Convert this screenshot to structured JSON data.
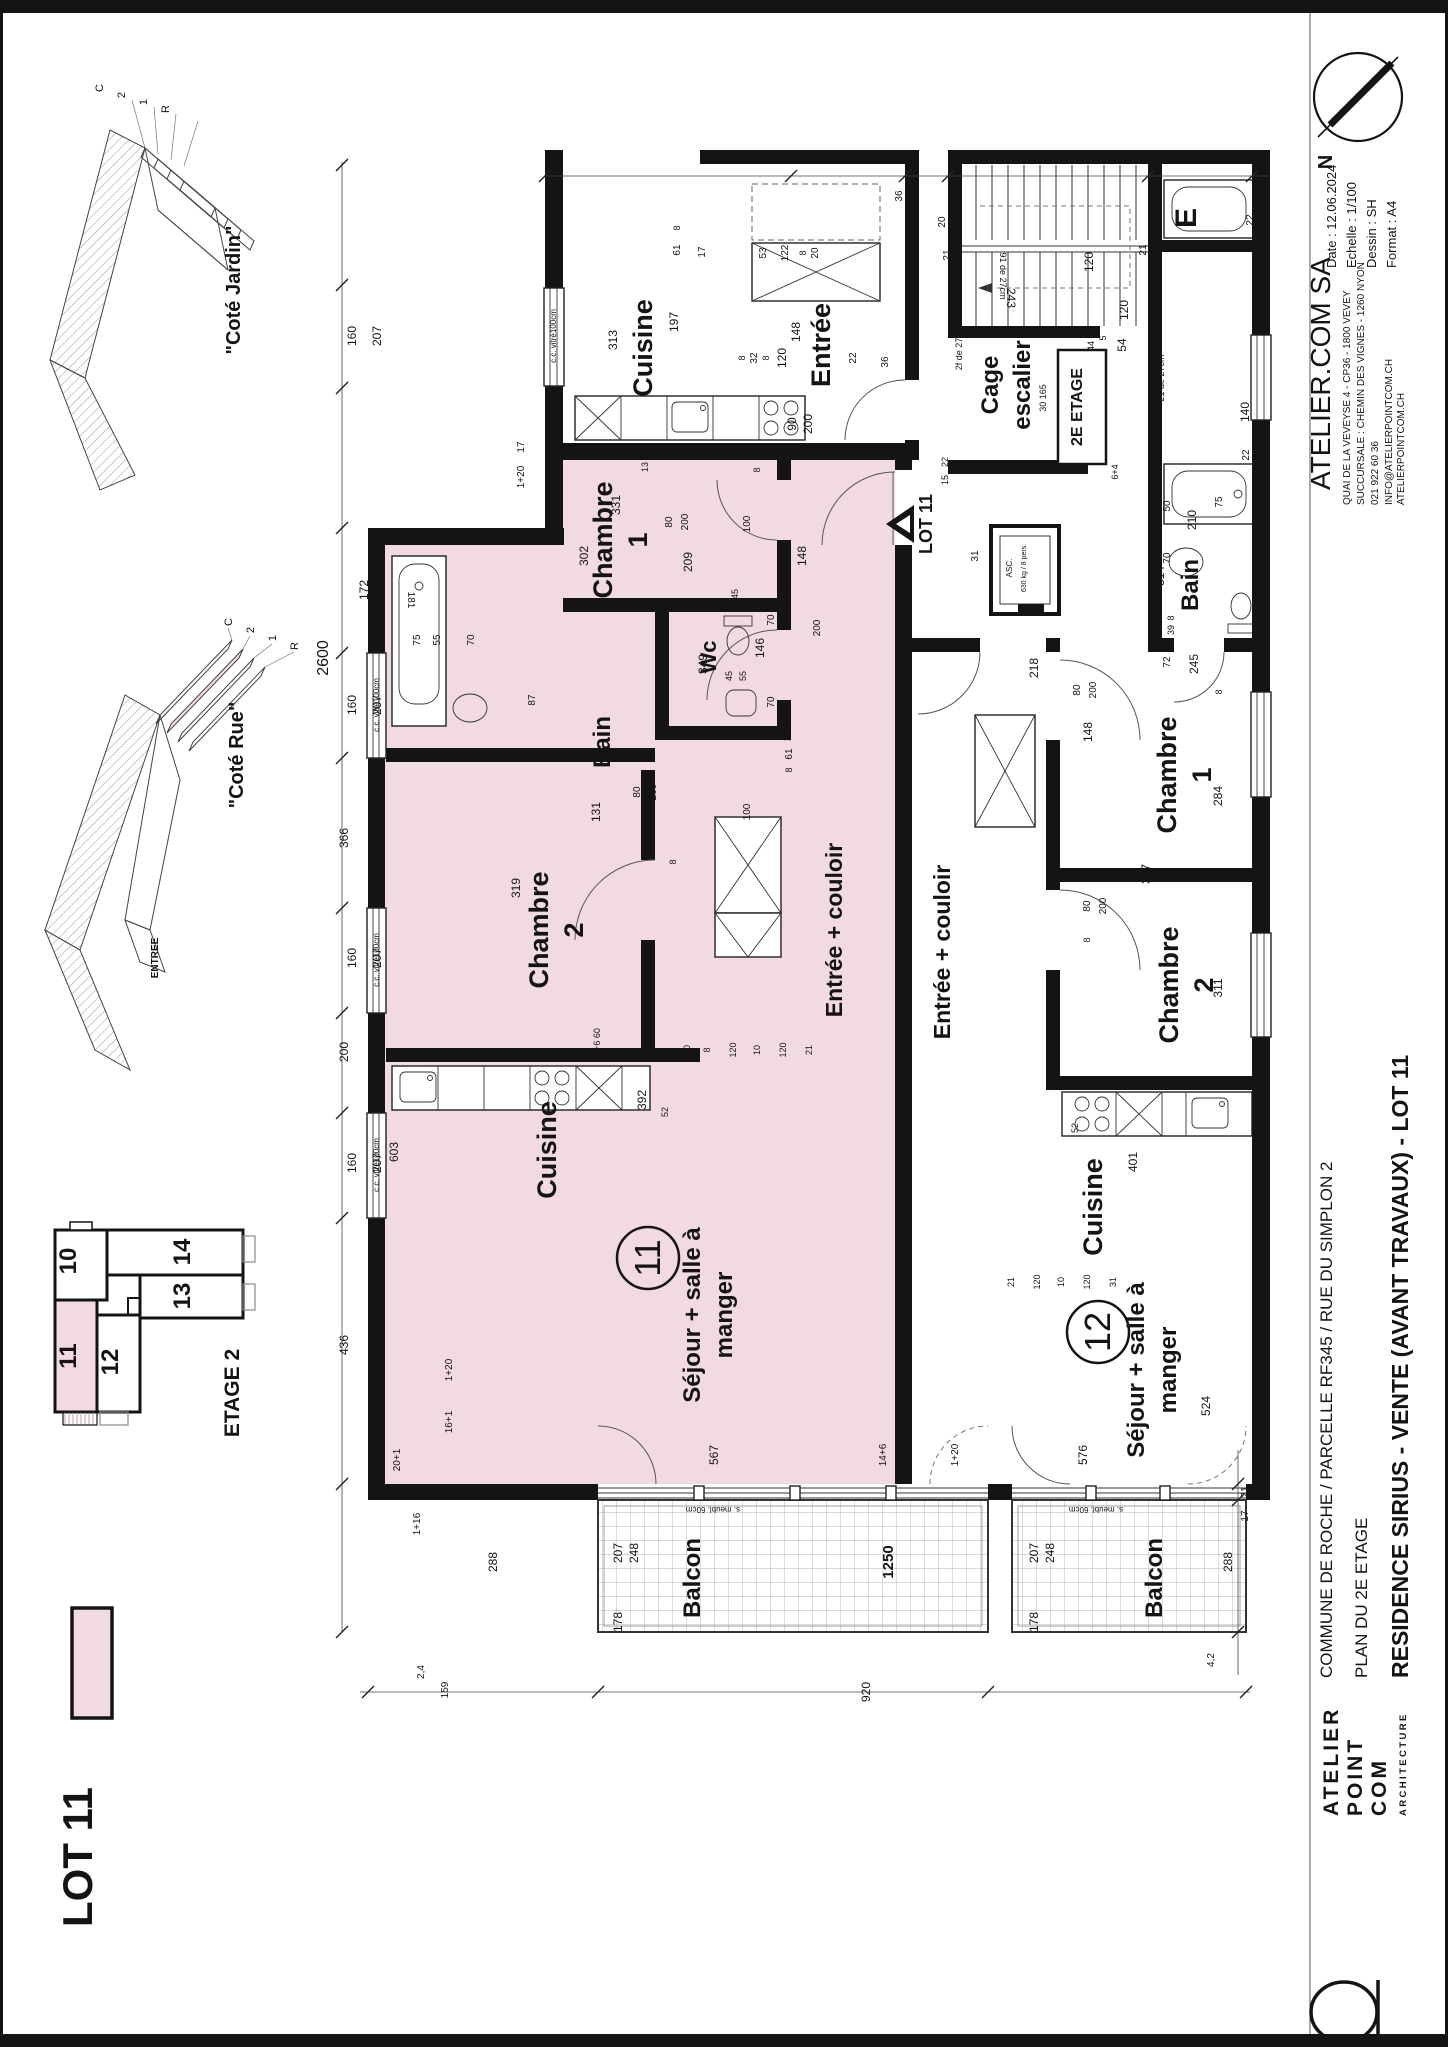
{
  "page": {
    "ink": "#141414",
    "pink": "#f2dae1",
    "pink_line": "#caa3ad"
  },
  "north": {
    "label": "N"
  },
  "title_block": {
    "company": "ATELIER.COM SA",
    "address1": "QUAI DE LA VEVEYSE 4 - CP36 - 1800 VEVEY",
    "address2": "SUCCURSALE : CHEMIN DES VIGNES - 1260 NYON",
    "phone": "021 922 60 36",
    "email": "INFO@ATELIERPOINTCOM.CH",
    "web": "ATELIERPOINTCOM.CH",
    "date": "Date : 12.06.2024",
    "scale": "Echelle : 1/100",
    "drawn": "Dessin : SH",
    "format": "Format : A4"
  },
  "project": {
    "line1": "COMMUNE DE ROCHE / PARCELLE RF345 / RUE DU SIMPLON 2",
    "line2": "PLAN DU 2E ETAGE",
    "line3": "RESIDENCE SIRIUS - VENTE (AVANT TRAVAUX) - LOT 11"
  },
  "logo": {
    "l1": "ATELIER",
    "l2": "POINT",
    "l3": "COM",
    "l4": "ARCHITECTURE"
  },
  "legend": {
    "label": "LOT 11"
  },
  "keyplan": {
    "title": "ETAGE 2",
    "units": [
      {
        "label": "10"
      },
      {
        "label": "14"
      },
      {
        "label": "13"
      },
      {
        "label": "11"
      },
      {
        "label": "12"
      }
    ]
  },
  "axons": [
    {
      "caption": "\"Coté Jardin\"",
      "floors": [
        "C",
        "2",
        "1",
        "R"
      ]
    },
    {
      "caption": "\"Coté Rue\"",
      "floors": [
        "C",
        "2",
        "1",
        "R"
      ],
      "entry": "ENTREE"
    }
  ],
  "plan": {
    "window_text": "c.c. vitré100cm",
    "lot_tag": {
      "label": "LOT 11",
      "x": 930,
      "y": 524
    },
    "stair_box": {
      "label": "2E ETAGE",
      "x": 1082,
      "y": 407
    },
    "unit_badges": [
      {
        "num": "11",
        "x": 648,
        "y": 1258
      },
      {
        "num": "12",
        "x": 1098,
        "y": 1332
      }
    ],
    "windows": [
      {
        "x": 556,
        "y": 336
      },
      {
        "x": 379,
        "y": 705
      },
      {
        "x": 379,
        "y": 960
      },
      {
        "x": 379,
        "y": 1165
      }
    ],
    "rooms": [
      {
        "label": "Cuisine",
        "x": 652,
        "y": 348,
        "s": 27
      },
      {
        "label": "Entrée",
        "x": 830,
        "y": 345,
        "s": 27
      },
      {
        "lines": [
          "Cage",
          "escalier"
        ],
        "x": 998,
        "y": 385,
        "s": 24
      },
      {
        "lines": [
          "Chambre",
          "1"
        ],
        "x": 612,
        "y": 540,
        "s": 27
      },
      {
        "label": "Wc",
        "x": 716,
        "y": 657,
        "s": 22
      },
      {
        "label": "Bain",
        "x": 610,
        "y": 742,
        "s": 24
      },
      {
        "lines": [
          "Chambre",
          "2"
        ],
        "x": 548,
        "y": 930,
        "s": 27
      },
      {
        "label": "Entrée + couloir",
        "x": 842,
        "y": 930,
        "s": 23
      },
      {
        "label": "Cuisine",
        "x": 556,
        "y": 1150,
        "s": 27
      },
      {
        "lines": [
          "Séjour + salle à",
          "manger"
        ],
        "x": 700,
        "y": 1315,
        "s": 24
      },
      {
        "label": "Balcon",
        "x": 700,
        "y": 1578,
        "s": 24
      },
      {
        "label": "Bain",
        "x": 1198,
        "y": 585,
        "s": 24
      },
      {
        "lines": [
          "Chambre",
          "1"
        ],
        "x": 1176,
        "y": 775,
        "s": 27
      },
      {
        "lines": [
          "Chambre",
          "2"
        ],
        "x": 1178,
        "y": 985,
        "s": 27
      },
      {
        "label": "Entrée + couloir",
        "x": 950,
        "y": 952,
        "s": 23
      },
      {
        "label": "Cuisine",
        "x": 1102,
        "y": 1207,
        "s": 27
      },
      {
        "lines": [
          "Séjour + salle à",
          "manger"
        ],
        "x": 1144,
        "y": 1370,
        "s": 24
      },
      {
        "label": "Balcon",
        "x": 1162,
        "y": 1578,
        "s": 24
      },
      {
        "label": "E",
        "x": 1196,
        "y": 218,
        "s": 30
      }
    ],
    "notes": [
      {
        "t": "s. meubl. 60cm",
        "x": 713,
        "y": 1507,
        "r": 180,
        "s": 8
      },
      {
        "t": "s. meubl. 60cm",
        "x": 1096,
        "y": 1507,
        "r": 180,
        "s": 8
      },
      {
        "t": "ASC.",
        "x": 1012,
        "y": 568,
        "s": 8
      },
      {
        "t": "630 kg / 8 pers.",
        "x": 1026,
        "y": 568,
        "s": 7
      },
      {
        "t": "91 de 27cm",
        "x": 1000,
        "y": 276,
        "r": 90,
        "s": 9
      },
      {
        "t": "21 de 27cm",
        "x": 1164,
        "y": 378,
        "s": 9
      },
      {
        "t": "2f de 27cm",
        "x": 962,
        "y": 348,
        "s": 9
      },
      {
        "t": "30 165",
        "x": 1046,
        "y": 398,
        "s": 9
      }
    ],
    "dims": [
      {
        "v": "2600",
        "x": 328,
        "y": 658,
        "s": 16
      },
      {
        "v": "160",
        "x": 356,
        "y": 336
      },
      {
        "v": "207",
        "x": 381,
        "y": 336
      },
      {
        "v": "172",
        "x": 368,
        "y": 590
      },
      {
        "v": "160",
        "x": 356,
        "y": 705
      },
      {
        "v": "207",
        "x": 381,
        "y": 705
      },
      {
        "v": "366",
        "x": 348,
        "y": 838
      },
      {
        "v": "160",
        "x": 356,
        "y": 958
      },
      {
        "v": "207",
        "x": 381,
        "y": 958
      },
      {
        "v": "200",
        "x": 348,
        "y": 1052
      },
      {
        "v": "160",
        "x": 356,
        "y": 1163
      },
      {
        "v": "207",
        "x": 381,
        "y": 1163
      },
      {
        "v": "436",
        "x": 348,
        "y": 1345
      },
      {
        "v": "313",
        "x": 617,
        "y": 340
      },
      {
        "v": "197",
        "x": 678,
        "y": 322
      },
      {
        "v": "61",
        "x": 680,
        "y": 250,
        "s": 10
      },
      {
        "v": "8",
        "x": 680,
        "y": 228,
        "s": 9
      },
      {
        "v": "20",
        "x": 945,
        "y": 222,
        "s": 10
      },
      {
        "v": "21",
        "x": 950,
        "y": 255,
        "s": 10
      },
      {
        "v": "22",
        "x": 1253,
        "y": 220,
        "s": 10
      },
      {
        "v": "36",
        "x": 902,
        "y": 196,
        "s": 10
      },
      {
        "v": "17",
        "x": 705,
        "y": 252,
        "s": 10
      },
      {
        "v": "53",
        "x": 766,
        "y": 253,
        "s": 10
      },
      {
        "v": "122",
        "x": 788,
        "y": 253,
        "s": 10
      },
      {
        "v": "8",
        "x": 806,
        "y": 253,
        "s": 9
      },
      {
        "v": "20",
        "x": 818,
        "y": 253,
        "s": 10
      },
      {
        "v": "148",
        "x": 800,
        "y": 332
      },
      {
        "v": "8",
        "x": 745,
        "y": 358,
        "s": 9
      },
      {
        "v": "32",
        "x": 757,
        "y": 358,
        "s": 10
      },
      {
        "v": "8",
        "x": 769,
        "y": 358,
        "s": 9
      },
      {
        "v": "120",
        "x": 786,
        "y": 358
      },
      {
        "v": "22",
        "x": 856,
        "y": 358,
        "s": 10
      },
      {
        "v": "36",
        "x": 888,
        "y": 362,
        "s": 10
      },
      {
        "v": "90",
        "x": 796,
        "y": 424
      },
      {
        "v": "200",
        "x": 812,
        "y": 424
      },
      {
        "v": "19",
        "x": 788,
        "y": 468,
        "s": 10
      },
      {
        "v": "243",
        "x": 1007,
        "y": 298,
        "r": 90
      },
      {
        "v": "120",
        "x": 1093,
        "y": 262
      },
      {
        "v": "120",
        "x": 1128,
        "y": 310
      },
      {
        "v": "54",
        "x": 1126,
        "y": 345
      },
      {
        "v": "5",
        "x": 1106,
        "y": 338,
        "s": 9
      },
      {
        "v": "44",
        "x": 1094,
        "y": 346,
        "s": 9
      },
      {
        "v": "21",
        "x": 1146,
        "y": 250,
        "s": 10
      },
      {
        "v": "314",
        "x": 1164,
        "y": 576
      },
      {
        "v": "22",
        "x": 1156,
        "y": 455,
        "s": 10
      },
      {
        "v": "140",
        "x": 1249,
        "y": 412
      },
      {
        "v": "22",
        "x": 1249,
        "y": 455,
        "s": 10
      },
      {
        "v": "218",
        "x": 1038,
        "y": 668
      },
      {
        "v": "31",
        "x": 978,
        "y": 556,
        "s": 10
      },
      {
        "v": "22",
        "x": 948,
        "y": 462,
        "s": 9
      },
      {
        "v": "15",
        "x": 948,
        "y": 480,
        "s": 9
      },
      {
        "v": "331",
        "x": 620,
        "y": 505
      },
      {
        "v": "302",
        "x": 588,
        "y": 556
      },
      {
        "v": "209",
        "x": 692,
        "y": 562
      },
      {
        "v": "1+20",
        "x": 524,
        "y": 477,
        "s": 10
      },
      {
        "v": "21",
        "x": 556,
        "y": 472,
        "s": 10
      },
      {
        "v": "17",
        "x": 524,
        "y": 447,
        "s": 10
      },
      {
        "v": "13",
        "x": 648,
        "y": 467,
        "s": 9
      },
      {
        "v": "80",
        "x": 672,
        "y": 522,
        "s": 10
      },
      {
        "v": "200",
        "x": 688,
        "y": 522,
        "s": 10
      },
      {
        "v": "8",
        "x": 760,
        "y": 470,
        "s": 9
      },
      {
        "v": "45",
        "x": 738,
        "y": 594,
        "s": 9
      },
      {
        "v": "45",
        "x": 732,
        "y": 676,
        "s": 9
      },
      {
        "v": "55",
        "x": 746,
        "y": 676,
        "s": 9
      },
      {
        "v": "146",
        "x": 764,
        "y": 648
      },
      {
        "v": "70",
        "x": 774,
        "y": 620,
        "s": 10
      },
      {
        "v": "70",
        "x": 774,
        "y": 702,
        "s": 10
      },
      {
        "v": "8",
        "x": 790,
        "y": 588,
        "s": 9
      },
      {
        "v": "41",
        "x": 790,
        "y": 600,
        "s": 9
      },
      {
        "v": "200",
        "x": 820,
        "y": 628,
        "s": 10
      },
      {
        "v": "8",
        "x": 790,
        "y": 724,
        "s": 9
      },
      {
        "v": "20",
        "x": 790,
        "y": 736,
        "s": 9
      },
      {
        "v": "61",
        "x": 792,
        "y": 754,
        "s": 10
      },
      {
        "v": "8",
        "x": 792,
        "y": 770,
        "s": 9
      },
      {
        "v": "181",
        "x": 408,
        "y": 600,
        "r": 90,
        "s": 10
      },
      {
        "v": "75",
        "x": 420,
        "y": 640,
        "s": 10
      },
      {
        "v": "55",
        "x": 440,
        "y": 640,
        "s": 10
      },
      {
        "v": "70",
        "x": 474,
        "y": 640,
        "s": 10
      },
      {
        "v": "87",
        "x": 535,
        "y": 700,
        "s": 10
      },
      {
        "v": "131",
        "x": 600,
        "y": 812
      },
      {
        "v": "349",
        "x": 707,
        "y": 664
      },
      {
        "v": "319",
        "x": 520,
        "y": 888
      },
      {
        "v": "80",
        "x": 640,
        "y": 792,
        "s": 10
      },
      {
        "v": "200",
        "x": 656,
        "y": 792,
        "s": 10
      },
      {
        "v": "8",
        "x": 676,
        "y": 862,
        "s": 9
      },
      {
        "v": "100",
        "x": 750,
        "y": 524,
        "s": 10
      },
      {
        "v": "100",
        "x": 750,
        "y": 812,
        "s": 10
      },
      {
        "v": "148",
        "x": 806,
        "y": 556
      },
      {
        "v": "392",
        "x": 646,
        "y": 1100
      },
      {
        "v": "52",
        "x": 668,
        "y": 1112,
        "s": 9
      },
      {
        "v": "4+6 60",
        "x": 600,
        "y": 1042,
        "s": 9
      },
      {
        "v": "603",
        "x": 398,
        "y": 1152
      },
      {
        "v": "567",
        "x": 718,
        "y": 1455
      },
      {
        "v": "16+1",
        "x": 452,
        "y": 1422,
        "s": 10
      },
      {
        "v": "1+20",
        "x": 452,
        "y": 1370,
        "s": 10
      },
      {
        "v": "20+1",
        "x": 400,
        "y": 1460,
        "s": 10
      },
      {
        "v": "1+16",
        "x": 420,
        "y": 1524,
        "s": 10
      },
      {
        "v": "14+6",
        "x": 886,
        "y": 1455,
        "s": 10
      },
      {
        "v": "288",
        "x": 1232,
        "y": 1562
      },
      {
        "v": "17",
        "x": 1248,
        "y": 1516,
        "s": 10
      },
      {
        "v": "21",
        "x": 1248,
        "y": 1492,
        "s": 10
      },
      {
        "v": "207",
        "x": 1038,
        "y": 1553
      },
      {
        "v": "248",
        "x": 1054,
        "y": 1553
      },
      {
        "v": "178",
        "x": 1038,
        "y": 1622
      },
      {
        "v": "288",
        "x": 497,
        "y": 1562
      },
      {
        "v": "207",
        "x": 622,
        "y": 1553
      },
      {
        "v": "248",
        "x": 638,
        "y": 1553
      },
      {
        "v": "178",
        "x": 622,
        "y": 1622
      },
      {
        "v": "1250",
        "x": 893,
        "y": 1562,
        "s": 15,
        "w": 700
      },
      {
        "v": "920",
        "x": 870,
        "y": 1692
      },
      {
        "v": "159",
        "x": 448,
        "y": 1690,
        "s": 10
      },
      {
        "v": "2,4",
        "x": 424,
        "y": 1672,
        "s": 10
      },
      {
        "v": "4,2",
        "x": 1214,
        "y": 1660,
        "s": 10
      },
      {
        "v": "75",
        "x": 1222,
        "y": 502,
        "s": 10
      },
      {
        "v": "210",
        "x": 1196,
        "y": 520
      },
      {
        "v": "50",
        "x": 1170,
        "y": 506,
        "s": 10
      },
      {
        "v": "70",
        "x": 1170,
        "y": 558,
        "s": 10
      },
      {
        "v": "39",
        "x": 1174,
        "y": 630,
        "s": 9
      },
      {
        "v": "8",
        "x": 1174,
        "y": 618,
        "s": 9
      },
      {
        "v": "72",
        "x": 1170,
        "y": 662,
        "s": 10
      },
      {
        "v": "245",
        "x": 1198,
        "y": 664
      },
      {
        "v": "6+4",
        "x": 1118,
        "y": 472,
        "s": 9
      },
      {
        "v": "148",
        "x": 1092,
        "y": 732
      },
      {
        "v": "80",
        "x": 1080,
        "y": 690,
        "s": 10
      },
      {
        "v": "200",
        "x": 1096,
        "y": 690,
        "s": 10
      },
      {
        "v": "387",
        "x": 1150,
        "y": 874
      },
      {
        "v": "284",
        "x": 1222,
        "y": 796
      },
      {
        "v": "8",
        "x": 1222,
        "y": 692,
        "s": 9
      },
      {
        "v": "311",
        "x": 1222,
        "y": 988
      },
      {
        "v": "80",
        "x": 1090,
        "y": 906,
        "s": 10
      },
      {
        "v": "200",
        "x": 1106,
        "y": 906,
        "s": 10
      },
      {
        "v": "8",
        "x": 1090,
        "y": 940,
        "s": 9
      },
      {
        "v": "217",
        "x": 1058,
        "y": 1022
      },
      {
        "v": "401",
        "x": 1137,
        "y": 1162
      },
      {
        "v": "52",
        "x": 1078,
        "y": 1128,
        "s": 9
      },
      {
        "v": "524",
        "x": 1210,
        "y": 1406
      },
      {
        "v": "576",
        "x": 1087,
        "y": 1455
      },
      {
        "v": "1+20",
        "x": 958,
        "y": 1455,
        "s": 10
      },
      {
        "v": "21",
        "x": 1014,
        "y": 1282,
        "s": 9
      },
      {
        "v": "120",
        "x": 1040,
        "y": 1282,
        "s": 9
      },
      {
        "v": "10",
        "x": 1064,
        "y": 1282,
        "s": 9
      },
      {
        "v": "120",
        "x": 1090,
        "y": 1282,
        "s": 9
      },
      {
        "v": "31",
        "x": 1116,
        "y": 1282,
        "s": 9
      },
      {
        "v": "80",
        "x": 690,
        "y": 1050,
        "s": 9
      },
      {
        "v": "8",
        "x": 710,
        "y": 1050,
        "s": 9
      },
      {
        "v": "120",
        "x": 736,
        "y": 1050,
        "s": 9
      },
      {
        "v": "10",
        "x": 760,
        "y": 1050,
        "s": 9
      },
      {
        "v": "120",
        "x": 786,
        "y": 1050,
        "s": 9
      },
      {
        "v": "21",
        "x": 812,
        "y": 1050,
        "s": 9
      }
    ]
  }
}
